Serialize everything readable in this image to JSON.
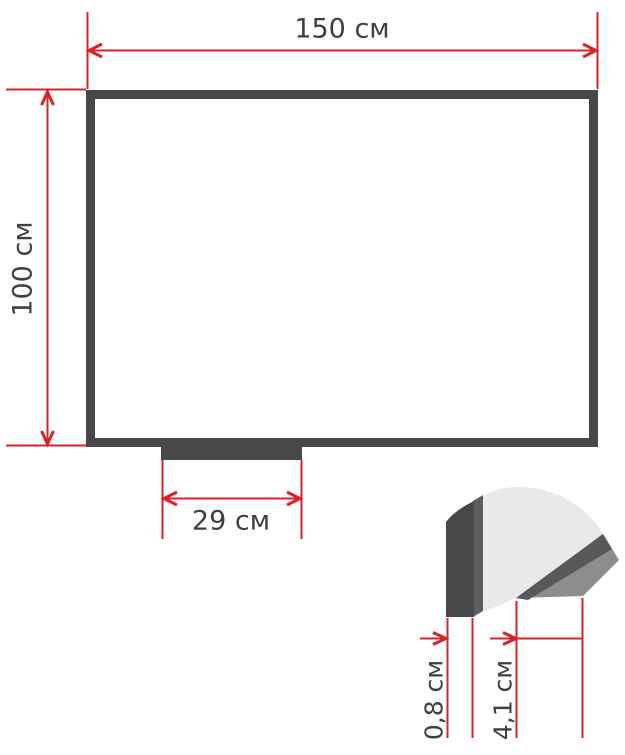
{
  "canvas": {
    "width_px": 625,
    "height_px": 755
  },
  "colors": {
    "background": "#ffffff",
    "dimension_red": "#d8232a",
    "frame_dark": "#48484b",
    "text_dark": "#3e4045",
    "profile_light": "#e9e9e9",
    "profile_mid": "#5d5d5f",
    "profile_shadow": "#59595c",
    "profile_inner": "#8d8d8d"
  },
  "board": {
    "width_label": "150 см",
    "height_label": "100 см"
  },
  "tray": {
    "width_label": "29 см"
  },
  "profile": {
    "frame_thickness_label": "0,8 см",
    "tray_depth_label": "4,1 см"
  }
}
